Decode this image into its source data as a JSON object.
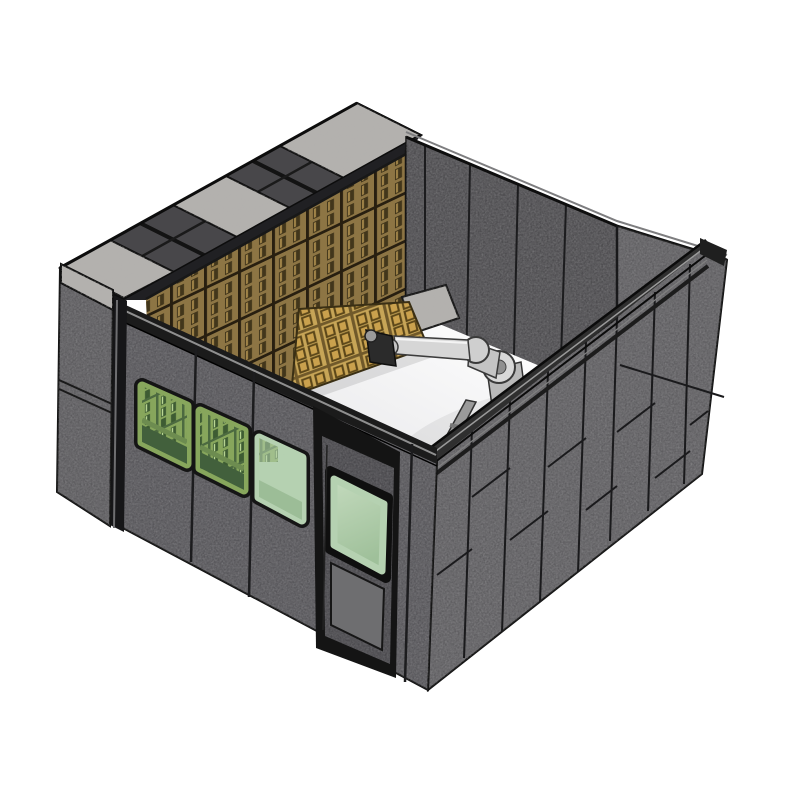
{
  "scene": {
    "type": "cad-3d-render",
    "subject": "robotic acoustic-panel enclosure",
    "objects": [
      "granite-capped top frame",
      "slotted wood acoustic panel wall",
      "tilted wood panel",
      "industrial robot arm",
      "robot pedestal",
      "linear safety rail",
      "front wall with windows",
      "personnel door with window",
      "right exterior panel wall",
      "white floor"
    ]
  },
  "palette": {
    "bg": "#ffffff",
    "frame": "#141414",
    "wall_front": "#57565a",
    "wall_left": "#5c5b5e",
    "wall_back_right": "#4e4d50",
    "wall_right": "#5f5e61",
    "cap_frame": "#232325",
    "cap_open": "#48474a",
    "door_slab": "#4a494d",
    "door_lower": "#6e6e70",
    "wood_base": "#8d7544",
    "panel_base": "#c7a557",
    "granite": "#b3b1ae",
    "glass": "#b5d1b1",
    "glass_wood": "#87a65c",
    "glass_band": "#42603c",
    "floor": "#ffffff",
    "robot_light": "#d6d6d6",
    "robot_dark": "#3a3a3c",
    "rail": "#2f2f2f",
    "accent_red": "#7c1712"
  }
}
